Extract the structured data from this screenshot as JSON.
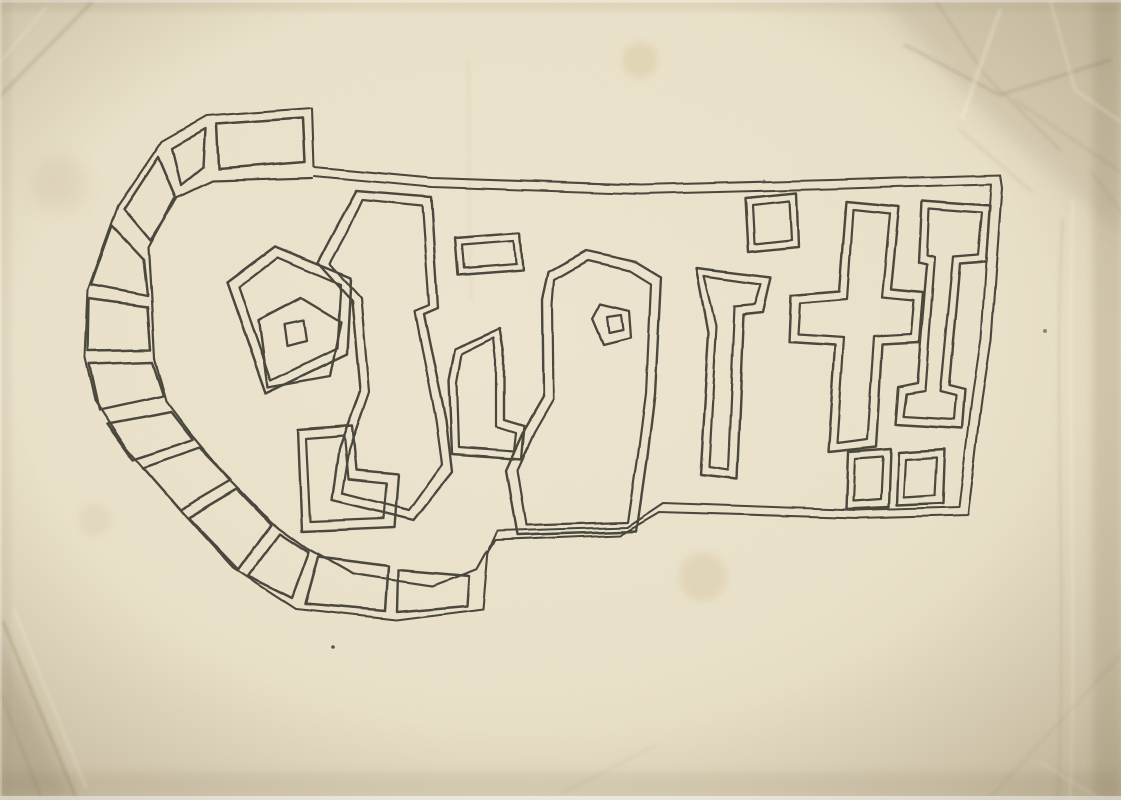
{
  "artwork": {
    "depicted_text": "dig it!",
    "description": "hand-drawn ink outline lettering on aged creased paper with segmented arc",
    "ink_color": "#3a372e",
    "paper_color": "#ece3cd",
    "paper_edge_color": "#d6cab0",
    "paths": [
      {
        "n": "sign-contour-outer",
        "w": 2.1,
        "d": "M312,108 L206,116 L162,141 L118,206 L88,290 L85,358 L95,401 L126,448 L176,506 L233,568 L296,609 L397,620 L483,609 L488,551 L495,540 L621,535 L660,512 L857,518 L968,515 L982,400 L991,340 L1002,188 L1000,175 L831,180 L641,185 L432,178 L314,167 Z"
      },
      {
        "n": "sign-contour-inner",
        "w": 2.0,
        "d": "M314,176 L432,187 L641,194 L830,189 L991,184 L981,338 L972,399 L959,507 L856,510 L664,503 L628,527 L497,531 L489,548"
      },
      {
        "n": "arc-inner-edge",
        "w": 2.2,
        "d": "M312,178 L212,181 L174,199 L148,247 L151,300 L154,358 L166,401 L191,434 L229,479 L271,522 L307,548 L353,574 L433,586 L477,569 L487,551"
      },
      {
        "n": "arc-brick-1",
        "w": 2.5,
        "d": "M216,124 L303,118 L305,162 L218,169 Z"
      },
      {
        "n": "arc-brick-2",
        "w": 2.4,
        "d": "M172,148 L205,129 L203,167 L181,185 Z"
      },
      {
        "n": "arc-brick-3",
        "w": 2.5,
        "d": "M158,157 L176,199 L150,240 L124,209 Z"
      },
      {
        "n": "arc-brick-4",
        "w": 2.4,
        "d": "M112,226 L143,259 L147,296 L91,285 Z"
      },
      {
        "n": "arc-brick-5",
        "w": 2.5,
        "d": "M89,299 L147,307 L150,350 L88,351 Z"
      },
      {
        "n": "arc-brick-6",
        "w": 2.4,
        "d": "M89,364 L152,362 L163,396 L99,410 Z"
      },
      {
        "n": "arc-brick-7",
        "w": 2.5,
        "d": "M107,424 L171,412 L193,440 L133,460 Z"
      },
      {
        "n": "arc-brick-8",
        "w": 2.4,
        "d": "M143,468 L200,448 L231,480 L180,510 Z"
      },
      {
        "n": "arc-brick-9",
        "w": 2.5,
        "d": "M188,518 L237,489 L271,524 L238,570 Z"
      },
      {
        "n": "arc-brick-10",
        "w": 2.4,
        "d": "M248,576 L280,533 L309,552 L292,598 Z"
      },
      {
        "n": "arc-brick-11",
        "w": 2.5,
        "d": "M318,557 L389,566 L386,611 L305,604 Z"
      },
      {
        "n": "arc-brick-12",
        "w": 2.4,
        "d": "M399,570 L469,576 L467,606 L398,612 Z"
      },
      {
        "n": "letter-d-bowl-ring-outer",
        "w": 2.5,
        "d": "M275,246 L351,277 L347,354 L266,393 L227,282 Z"
      },
      {
        "n": "letter-d-bowl-ring-inner",
        "w": 2.3,
        "d": "M278,257 L341,284 L337,348 L271,380 L239,287 Z"
      },
      {
        "n": "letter-d-bowl-middle",
        "w": 2.4,
        "d": "M301,298 L341,322 L330,376 L268,387 L259,320 Z"
      },
      {
        "n": "letter-d-bowl-center-blob",
        "w": 2.3,
        "d": "M284,325 L303,321 L306,341 L287,346 Z"
      },
      {
        "n": "letter-d-stem-outer",
        "w": 2.4,
        "d": "M356,191 L431,197 L438,308 L424,314 L446,420 L452,472 L414,520 L332,500 L339,449 L360,391 L352,300 L318,262 L338,224 Z"
      },
      {
        "n": "letter-d-stem-inner",
        "w": 2.2,
        "d": "M362,200 L422,206 L429,305 L415,311 L436,420 L442,464 L409,510 L342,493 L349,450 L369,392 L361,297 L330,263 L348,230 Z"
      },
      {
        "n": "letter-d-foot-outer",
        "w": 2.4,
        "d": "M298,430 L352,426 L356,470 L398,474 L394,527 L302,531 Z"
      },
      {
        "n": "letter-d-foot-inner",
        "w": 2.2,
        "d": "M306,439 L344,436 L348,479 L386,483 L383,518 L310,521 Z"
      },
      {
        "n": "letter-i1-dot-outer",
        "w": 2.4,
        "d": "M455,237 L520,232 L523,270 L458,275 Z"
      },
      {
        "n": "letter-i1-dot-inner",
        "w": 2.2,
        "d": "M462,244 L514,240 L516,264 L464,268 Z"
      },
      {
        "n": "letter-i1-stem-outer",
        "w": 2.4,
        "d": "M455,349 L500,329 L504,352 L504,420 L524,426 L521,459 L452,454 L449,380 Z"
      },
      {
        "n": "letter-i1-stem-inner",
        "w": 2.2,
        "d": "M462,354 L494,338 L496,356 L496,427 L516,433 L514,451 L459,447 L457,382 Z"
      },
      {
        "n": "letter-g-body-outer",
        "w": 2.4,
        "d": "M548,272 L586,251 L636,262 L661,277 L655,395 L647,460 L637,531 L517,535 L506,470 L524,430 L543,397 L542,300 Z"
      },
      {
        "n": "letter-g-body-inner",
        "w": 2.2,
        "d": "M554,280 L587,261 L630,271 L651,284 L646,394 L638,455 L628,522 L526,525 L517,470 L534,433 L553,400 L552,305 Z"
      },
      {
        "n": "letter-g-eye",
        "w": 2.3,
        "d": "M600,304 L629,311 L631,338 L603,345 L592,319 Z"
      },
      {
        "n": "letter-g-eye-blob",
        "w": 2.2,
        "d": "M607,317 L621,315 L623,330 L609,333 Z"
      },
      {
        "n": "letter-i2-dot-outer",
        "w": 2.4,
        "d": "M745,198 L796,193 L798,247 L748,252 Z"
      },
      {
        "n": "letter-i2-dot-inner",
        "w": 2.2,
        "d": "M752,205 L789,201 L791,240 L754,244 Z"
      },
      {
        "n": "letter-i2-stem-outer",
        "w": 2.4,
        "d": "M697,268 L771,277 L763,312 L744,314 L737,479 L700,475 L709,332 Z"
      },
      {
        "n": "letter-i2-stem-inner",
        "w": 2.2,
        "d": "M705,276 L761,284 L755,304 L735,306 L728,470 L709,467 L717,325 Z"
      },
      {
        "n": "letter-t-outer",
        "w": 2.4,
        "d": "M846,202 L899,207 L891,289 L923,292 L919,343 L882,345 L876,447 L828,452 L835,346 L789,343 L791,295 L839,291 Z"
      },
      {
        "n": "letter-t-inner",
        "w": 2.2,
        "d": "M853,210 L890,214 L882,297 L914,300 L911,335 L874,337 L867,439 L837,443 L844,338 L798,335 L800,303 L847,299 Z"
      },
      {
        "n": "letter-t-foot-outer",
        "w": 2.4,
        "d": "M848,452 L891,449 L889,507 L846,509 Z"
      },
      {
        "n": "letter-t-foot-inner",
        "w": 2.2,
        "d": "M855,459 L883,457 L881,499 L853,501 Z"
      },
      {
        "n": "exclamation-outer",
        "w": 2.4,
        "d": "M922,201 L990,206 L986,262 L960,264 L949,385 L965,389 L962,428 L895,424 L898,387 L917,383 L927,264 L919,262 Z"
      },
      {
        "n": "exclamation-inner",
        "w": 2.2,
        "d": "M929,209 L982,213 L978,255 L953,257 L940,391 L956,395 L954,419 L903,416 L906,394 L925,391 L935,257 L927,255 Z"
      },
      {
        "n": "exclamation-dot-outer",
        "w": 2.4,
        "d": "M899,452 L945,449 L943,503 L897,505 Z"
      },
      {
        "n": "exclamation-dot-inner",
        "w": 2.2,
        "d": "M906,459 L937,457 L935,495 L904,497 Z"
      }
    ]
  }
}
